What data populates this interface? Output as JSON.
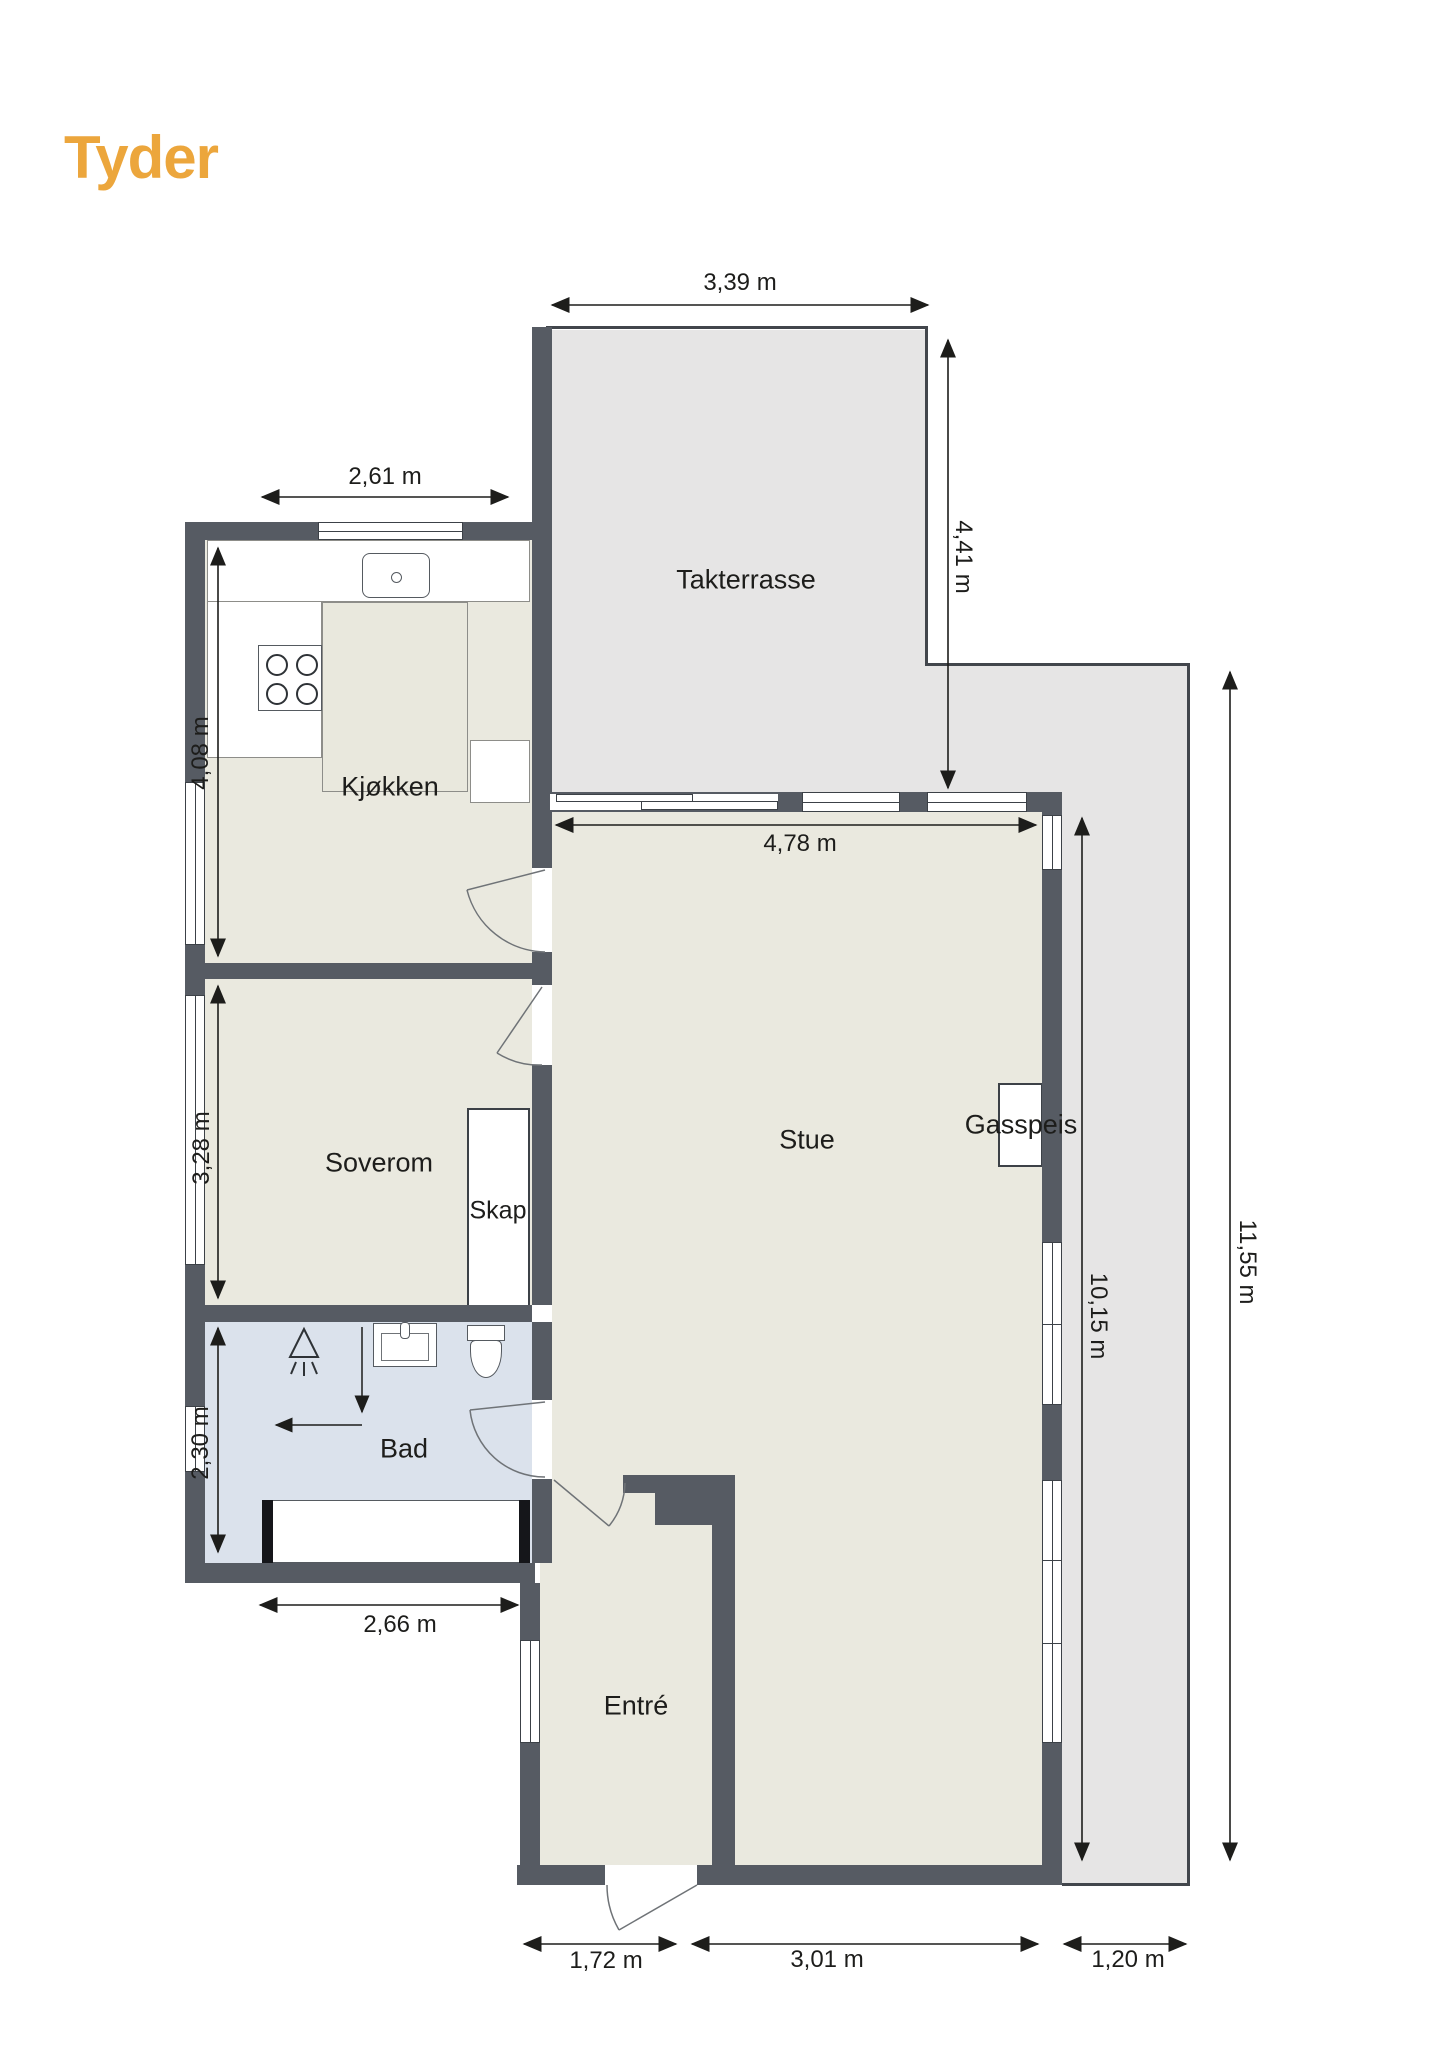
{
  "logo": {
    "text": "Tyder"
  },
  "colors": {
    "brand": "#eca63c",
    "wall": "#565b63",
    "floor": "#eae9df",
    "terrace": "#e6e5e5",
    "bathroom_floor": "#dbe2ec",
    "annotation": "#1d1d1b"
  },
  "rooms": {
    "takterrasse": "Takterrasse",
    "kjokken": "Kjøkken",
    "soverom": "Soverom",
    "skap": "Skap",
    "stue": "Stue",
    "gasspeis": "Gasspeis",
    "bad": "Bad",
    "entre": "Entré"
  },
  "dimensions": {
    "terrace_top_width": "3,39 m",
    "kitchen_width": "2,61 m",
    "terrace_depth": "4,41 m",
    "kitchen_depth": "4,08 m",
    "stue_width": "4,78 m",
    "soverom_depth": "3,28 m",
    "bad_depth": "2,30 m",
    "bad_width": "2,66 m",
    "stue_depth": "10,15 m",
    "right_side_total": "11,55 m",
    "entre_width": "1,72 m",
    "stue_bottom_width": "3,01 m",
    "terrace_strip_width": "1,20 m"
  }
}
